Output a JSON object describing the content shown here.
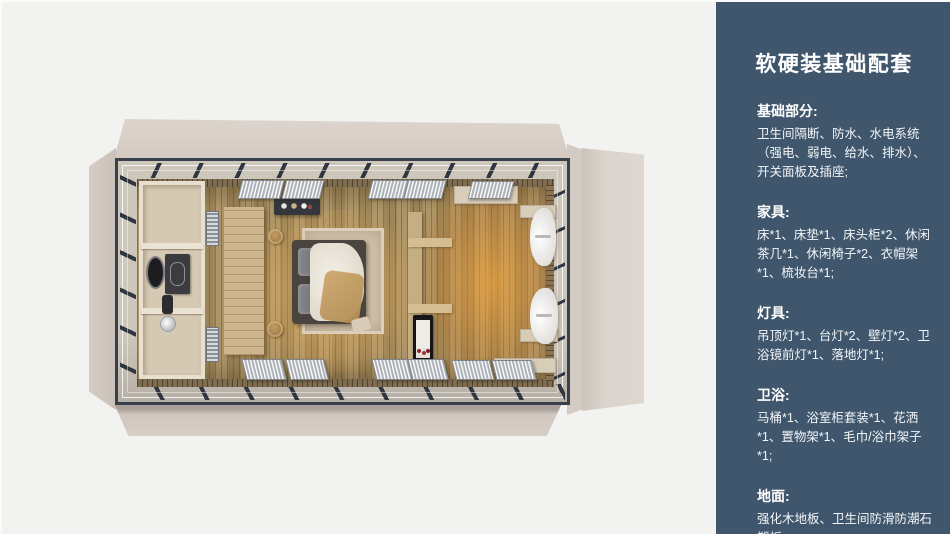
{
  "sidebar": {
    "title": "软硬装基础配套",
    "sections": [
      {
        "heading": "基础部分:",
        "body": "卫生间隔断、防水、水电系统（强电、弱电、给水、排水）、开关面板及插座;"
      },
      {
        "heading": "家具:",
        "body": "床*1、床垫*1、床头柜*2、休闲茶几*1、休闲椅子*2、衣帽架*1、梳妆台*1;"
      },
      {
        "heading": "灯具:",
        "body": "吊顶灯*1、台灯*2、壁灯*2、卫浴镜前灯*1、落地灯*1;"
      },
      {
        "heading": "卫浴:",
        "body": "马桶*1、浴室柜套装*1、花洒*1、置物架*1、毛巾/浴巾架子*1;"
      },
      {
        "heading": "地面:",
        "body": "强化木地板、卫生间防滑防潮石塑板;"
      }
    ],
    "colors": {
      "background": "#3f566c",
      "text": "#ffffff"
    }
  },
  "floorplan": {
    "kind": "top-down 3D render of prefab cabin suite",
    "zones": [
      "bathroom",
      "bedroom",
      "lounge"
    ],
    "colors": {
      "shell_beige": "#d5cdc5",
      "steel_frame": "#38404c",
      "glass_band": "#c9c2b7",
      "wood_floor": "#a68e60",
      "warm_glow": "#ffa837",
      "page_background": "#f2f2f1"
    }
  }
}
